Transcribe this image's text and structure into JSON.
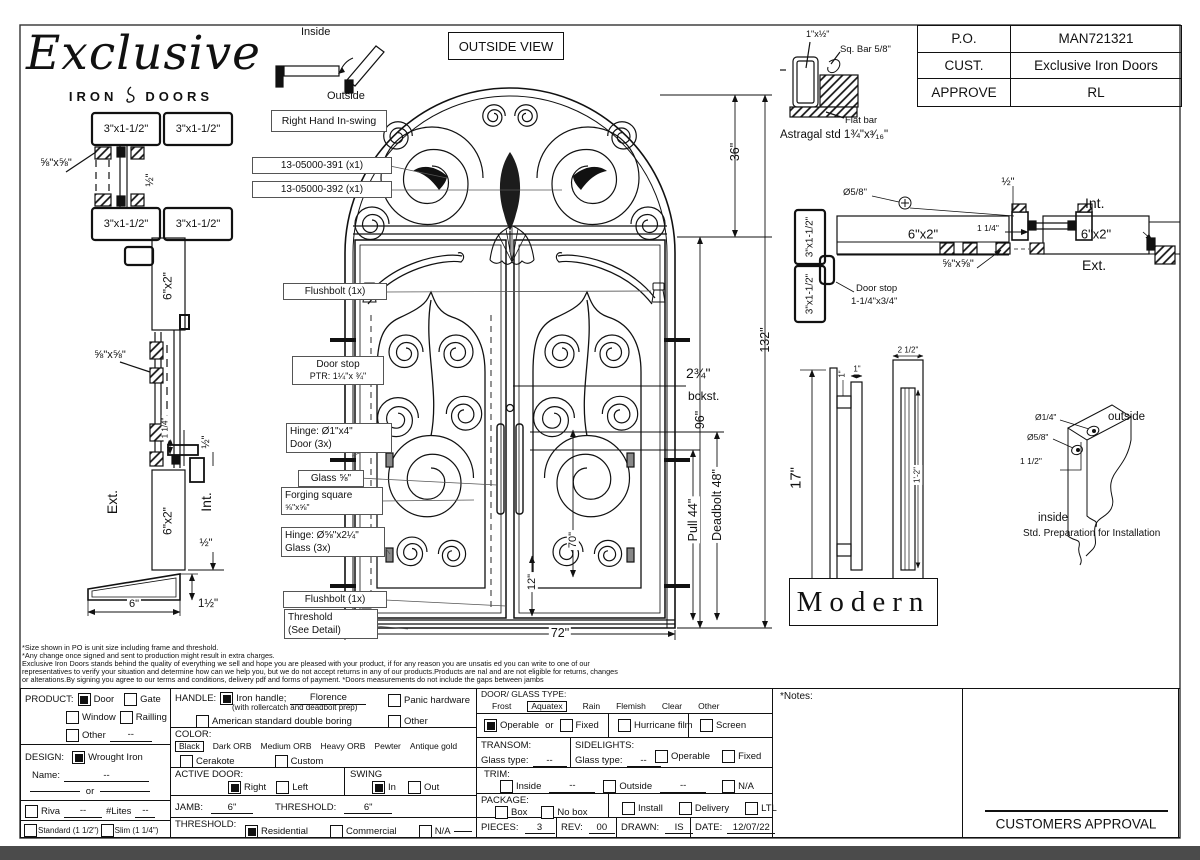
{
  "header": {
    "logo_script": "Exclusive",
    "logo_iron": "IRON",
    "logo_doors": "DOORS",
    "inside": "Inside",
    "outside": "Outside",
    "swing_label": "Right Hand In-swing",
    "view_label": "OUTSIDE VIEW"
  },
  "po_table": {
    "rows": [
      {
        "k": "P.O.",
        "v": "MAN721321"
      },
      {
        "k": "CUST.",
        "v": "Exclusive Iron Doors"
      },
      {
        "k": "APPROVE",
        "v": "RL"
      }
    ]
  },
  "astragal": {
    "dim": "1\"x½\"",
    "sq_bar": "Sq. Bar 5/8\"",
    "flat_bar": "Flat bar",
    "caption": "Astragal std 1¾\"x³⁄₁₆\""
  },
  "callouts": {
    "c391": "13-05000-391 (x1)",
    "c392": "13-05000-392 (x1)",
    "flushbolt": "Flushbolt (1x)",
    "door_stop_1": "Door stop",
    "door_stop_2": "PTR: 1¼\"x ¾\"",
    "hinge_door_1": "Hinge: Ø1\"x4\"",
    "hinge_door_2": "Door (3x)",
    "glass": "Glass ⅝\"",
    "forging_1": "Forging square",
    "forging_2": "⅝\"x⅝\"",
    "hinge_glass_1": "Hinge: Ø⅝\"x2¼\"",
    "hinge_glass_2": "Glass (3x)",
    "flushbolt2": "Flushbolt (1x)",
    "threshold_1": "Threshold",
    "threshold_2": "(See Detail)"
  },
  "dims": {
    "transom": "36\"",
    "overall": "132\"",
    "door": "96\"",
    "backset_1": "2¾\"",
    "backset_2": "bckst.",
    "pull": "Pull 44\"",
    "deadbolt": "Deadbolt 48\"",
    "glass_h": "70\"",
    "bottom": "12\"",
    "width": "72\""
  },
  "left_section": {
    "jamb": "3\"x1-1/2\"",
    "bar": "⅝\"x⅝\"",
    "half": "½\"",
    "tube": "6\"x2\"",
    "gap": "1 1/4\"",
    "ext": "Ext.",
    "int": "Int.",
    "six": "6\"",
    "one_half": "1½\""
  },
  "right_section": {
    "jamb": "3\"x1-1/2\"",
    "tube": "6\"x2\"",
    "dia": "Ø5/8\"",
    "half": "½\"",
    "gap": "1 1/4\"",
    "bar": "⅝\"x⅝\"",
    "int": "Int.",
    "ext": "Ext.",
    "door_stop_1": "Door stop",
    "door_stop_2": "1-1/4\"x3/4\""
  },
  "handle_detail": {
    "h": "17\"",
    "one_a": "1\"",
    "one_b": "1\"",
    "w": "2 1/2\"",
    "inner": "1'-2\"",
    "style": "Modern"
  },
  "prep": {
    "d1": "Ø1/4\"",
    "d2": "Ø5/8\"",
    "d3": "1 1/2\"",
    "outside": "outside",
    "inside": "inside",
    "caption": "Std. Preparation for Installation"
  },
  "disclaimer": [
    "*Size shown in PO is unit size including frame and threshold.",
    "*Any change once signed and sent to production might result in extra charges.",
    "Exclusive Iron Doors stands behind the quality of everything we sell and hope you are pleased with your product, if for any reason you are unsatis  ed you can write to one of our",
    "representatives to verify your situation and determine how can we help you, but we do not accept returns in any of our products.Products are   nal and are not eligible for returns, changes",
    "or alterations.By signing you agree to our terms and conditions, delivery pdf and forms of payment. *Doors measurements do not include the gaps between jambs"
  ],
  "form": {
    "product": {
      "label": "PRODUCT:",
      "door": "Door",
      "gate": "Gate",
      "window": "Window",
      "railling": "Railling",
      "other": "Other",
      "other_val": "--",
      "door_checked": true,
      "gate_checked": false,
      "window_checked": false,
      "railling_checked": false,
      "other_checked": false
    },
    "design": {
      "label": "DESIGN:",
      "wrought": "Wrought Iron",
      "wrought_checked": true,
      "name_label": "Name:",
      "name_val": "--",
      "or": "or"
    },
    "riva": {
      "label": "Riva",
      "checked": false,
      "val": "--",
      "lites": "#Lites",
      "lites_val": "--"
    },
    "thickness": {
      "standard": "Standard (1 1/2\")",
      "standard_checked": false,
      "slim": "Slim (1 1/4\")",
      "slim_checked": false
    },
    "handle": {
      "label": "HANDLE:",
      "iron": "Iron handle;",
      "iron_checked": true,
      "style": "Florence",
      "note": "(with rollercatch and deadbolt prep)",
      "american": "American standard double boring",
      "american_checked": false,
      "panic": "Panic hardware",
      "panic_checked": false,
      "other": "Other",
      "other_checked": false
    },
    "color": {
      "label": "COLOR:",
      "selected": "Black",
      "opt1": "Dark ORB",
      "opt2": "Medium ORB",
      "opt3": "Heavy ORB",
      "opt4": "Pewter",
      "opt5": "Antique gold",
      "cerakote": "Cerakote",
      "cerakote_checked": false,
      "custom": "Custom",
      "custom_checked": false
    },
    "active": {
      "label": "ACTIVE DOOR:",
      "right": "Right",
      "right_checked": true,
      "left": "Left",
      "left_checked": false
    },
    "swing": {
      "label": "SWING",
      "in": "In",
      "in_checked": true,
      "out": "Out",
      "out_checked": false
    },
    "jamb": {
      "label": "JAMB:",
      "val": "6\"",
      "t_label": "THRESHOLD:",
      "t_val": "6\""
    },
    "threshold": {
      "label": "THRESHOLD:",
      "residential": "Residential",
      "residential_checked": true,
      "commercial": "Commercial",
      "commercial_checked": false,
      "na": "N/A",
      "na_checked": false
    },
    "glass": {
      "label": "DOOR/ GLASS TYPE:",
      "frost": "Frost",
      "aquatex": "Aquatex",
      "rain": "Rain",
      "flemish": "Flemish",
      "clear": "Clear",
      "other": "Other"
    },
    "operable": {
      "operable": "Operable",
      "or": "or",
      "operable_checked": true,
      "fixed": "Fixed",
      "fixed_checked": false,
      "hurricane": "Hurricane film",
      "hurricane_checked": false,
      "screen": "Screen",
      "screen_checked": false
    },
    "transom": {
      "label": "TRANSOM:",
      "glass_label": "Glass type:",
      "val": "--"
    },
    "sidelights": {
      "label": "SIDELIGHTS:",
      "glass_label": "Glass type:",
      "val": "--",
      "operable": "Operable",
      "operable_checked": false,
      "fixed": "Fixed",
      "fixed_checked": false
    },
    "trim": {
      "label": "TRIM:",
      "inside": "Inside",
      "inside_checked": false,
      "inside_val": "--",
      "outside": "Outside",
      "outside_checked": false,
      "outside_val": "--",
      "na": "N/A",
      "na_checked": false
    },
    "package": {
      "label": "PACKAGE:",
      "box": "Box",
      "box_checked": false,
      "no_box": "No box",
      "no_box_checked": false,
      "install": "Install",
      "install_checked": false,
      "delivery": "Delivery",
      "delivery_checked": false,
      "ltl": "LTL",
      "ltl_checked": false
    },
    "meta": {
      "pieces_label": "PIECES:",
      "pieces": "3",
      "rev_label": "REV:",
      "rev": "00",
      "drawn_label": "DRAWN:",
      "drawn": "IS",
      "date_label": "DATE:",
      "date": "12/07/22"
    }
  },
  "notes_label": "*Notes:",
  "approval_label": "CUSTOMERS APPROVAL"
}
